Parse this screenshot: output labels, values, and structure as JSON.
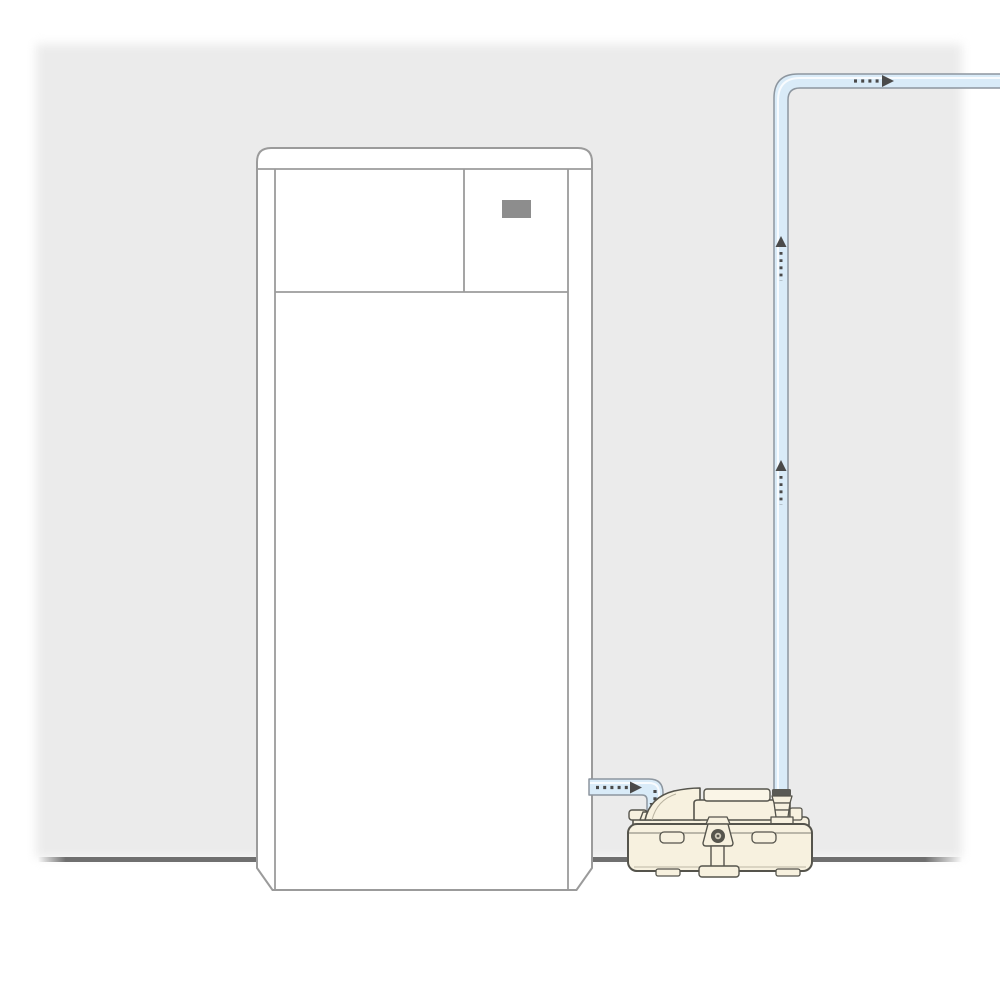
{
  "illustration": {
    "name": "boiler-condensate-pump-installation-diagram",
    "colors": {
      "page_bg": "#ffffff",
      "wall": "#ebebeb",
      "floor_line": "#6f6f6f",
      "boiler_fill": "#ffffff",
      "boiler_outline": "#9b9b9b",
      "display": "#8d8d8d",
      "pipe_fill": "#d9ebf8",
      "pipe_outline": "#8d969f",
      "pump_fill": "#f7f1df",
      "pump_fill_light": "#faf5e7",
      "pump_outline": "#55544c",
      "pump_clamp": "#5a5a55",
      "arrow": "#4a4a4a"
    },
    "elements": {
      "boiler": "floor-standing-boiler",
      "display": "boiler-display",
      "pump": "condensate-pump",
      "inlet_pipe": "boiler-to-pump-inlet-pipe",
      "riser_pipe": "pump-discharge-riser-pipe",
      "flow_arrows": "dashed-flow-direction-arrows"
    },
    "flow": {
      "inlet_arrows": 2,
      "riser_arrows": 2,
      "top_arrows": 1,
      "direction": "right-down-into-pump-then-up-and-right"
    }
  }
}
